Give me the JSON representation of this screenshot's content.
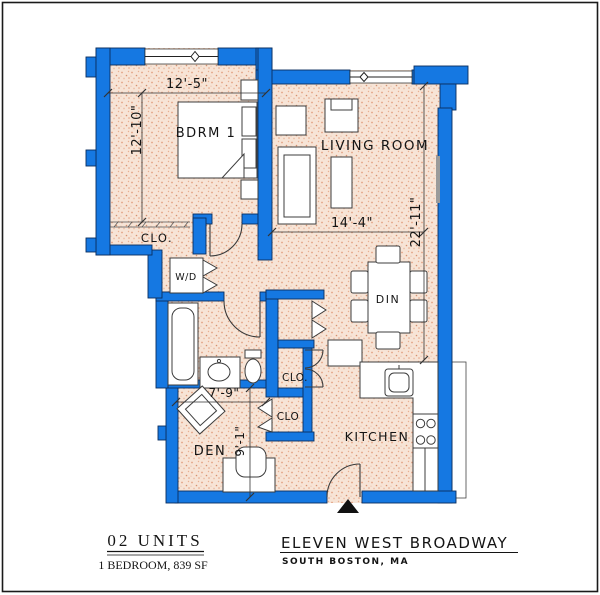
{
  "colors": {
    "wall_blue": "#1578e2",
    "wall_edge": "#0b2e5e",
    "floor_base": "#f7e4d6",
    "floor_dots": "#e2a184",
    "line_black": "#141414"
  },
  "rooms": {
    "bedroom": "BDRM 1",
    "living": "LIVING ROOM",
    "bedroom_closet": "CLO.",
    "washer_dryer": "W/D",
    "dining": "DIN",
    "linen_closet": "CLO.",
    "den_closet": "CLO",
    "den": "DEN",
    "kitchen": "KITCHEN"
  },
  "dimensions": {
    "bedroom_width": "12'-5\"",
    "bedroom_depth": "12'-10\"",
    "living_width": "14'-4\"",
    "unit_depth": "22'-11\"",
    "den_width": "7'-9\"",
    "den_depth": "9'-1\""
  },
  "title_block": {
    "units": "02 UNITS",
    "unit_type": "1 BEDROOM, 839 SF",
    "building": "ELEVEN WEST BROADWAY",
    "location": "SOUTH BOSTON, MA"
  }
}
